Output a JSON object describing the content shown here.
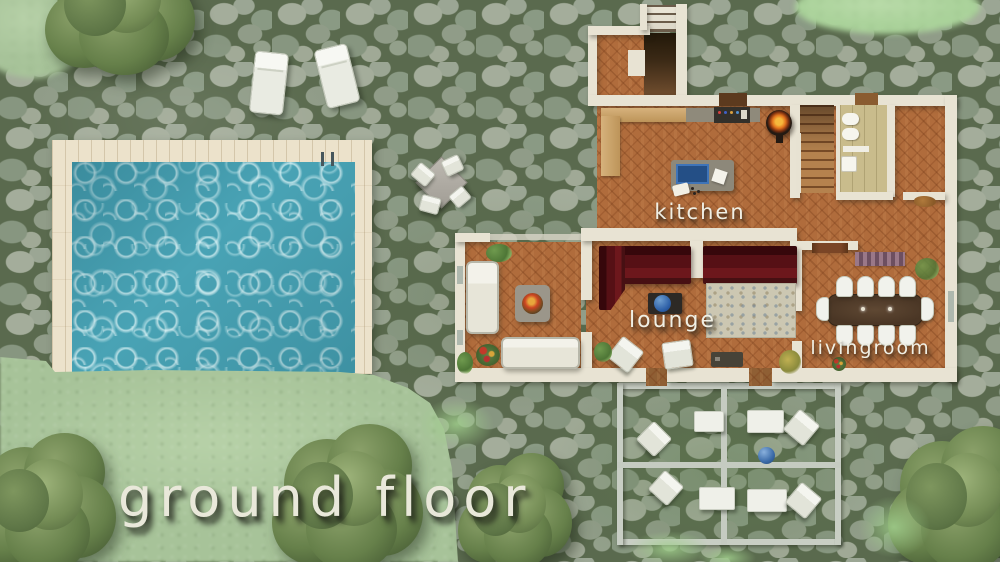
{
  "labels": {
    "title": "ground floor",
    "kitchen": "kitchen",
    "lounge": "lounge",
    "livingroom": "livingroom"
  },
  "palette": {
    "stone": "#8e9b86",
    "grass": "#a7c399",
    "pool_water": "#49a3b5",
    "pool_deck": "#ece2cb",
    "house_wall": "#e8e3d3",
    "terracotta_floor": "#b06c3c",
    "sofa_red": "#561015",
    "accent_blue": "#2c5ea6",
    "label_text": "#f0efe4"
  },
  "scene": {
    "sprites": [
      {
        "name": "tree-top-left",
        "type": "tree",
        "x": 45,
        "y": -62,
        "w": 155,
        "h": 140
      },
      {
        "name": "tree-bottom-left",
        "type": "tree",
        "x": -28,
        "y": 433,
        "w": 148,
        "h": 142
      },
      {
        "name": "tree-bottom-center",
        "type": "tree",
        "x": 272,
        "y": 424,
        "w": 156,
        "h": 150
      },
      {
        "name": "tree-bottom-mid",
        "type": "tree",
        "x": 458,
        "y": 453,
        "w": 118,
        "h": 118
      },
      {
        "name": "tree-bottom-right",
        "type": "tree",
        "x": 888,
        "y": 426,
        "w": 152,
        "h": 148
      },
      {
        "name": "sun-lounger-1",
        "type": "lounger",
        "x": 252,
        "y": 52,
        "w": 34,
        "h": 62,
        "rot": 6
      },
      {
        "name": "sun-lounger-2",
        "type": "lounger",
        "x": 320,
        "y": 46,
        "w": 34,
        "h": 60,
        "rot": -14
      },
      {
        "name": "patio-table",
        "type": "table-diamond",
        "x": 423,
        "y": 164,
        "w": 37,
        "h": 37,
        "rot": 45
      },
      {
        "name": "patio-chair-1",
        "type": "chair",
        "x": 413,
        "y": 166,
        "w": 20,
        "h": 17,
        "rot": 40
      },
      {
        "name": "patio-chair-2",
        "type": "chair",
        "x": 443,
        "y": 157,
        "w": 19,
        "h": 17,
        "rot": -25
      },
      {
        "name": "patio-chair-3",
        "type": "chair",
        "x": 420,
        "y": 196,
        "w": 20,
        "h": 17,
        "rot": 15
      },
      {
        "name": "patio-chair-4",
        "type": "chair",
        "x": 451,
        "y": 189,
        "w": 18,
        "h": 16,
        "rot": -40
      },
      {
        "name": "pergola-chair-1",
        "type": "chair",
        "x": 641,
        "y": 426,
        "w": 26,
        "h": 26,
        "rot": 45
      },
      {
        "name": "pergola-table-1",
        "type": "perg-table",
        "x": 694,
        "y": 411,
        "w": 30,
        "h": 21,
        "rot": 0
      },
      {
        "name": "pergola-table-2",
        "type": "perg-table",
        "x": 747,
        "y": 410,
        "w": 37,
        "h": 23,
        "rot": 0
      },
      {
        "name": "pergola-chair-2",
        "type": "chair",
        "x": 788,
        "y": 414,
        "w": 27,
        "h": 27,
        "rot": 40
      },
      {
        "name": "blue-pot",
        "type": "ball",
        "x": 758,
        "y": 447,
        "w": 17,
        "h": 17,
        "rot": 0
      },
      {
        "name": "pergola-chair-3",
        "type": "chair",
        "x": 653,
        "y": 475,
        "w": 26,
        "h": 26,
        "rot": 42
      },
      {
        "name": "pergola-table-3",
        "type": "perg-table",
        "x": 699,
        "y": 487,
        "w": 36,
        "h": 23,
        "rot": 0
      },
      {
        "name": "pergola-table-4",
        "type": "perg-table",
        "x": 747,
        "y": 489,
        "w": 40,
        "h": 23,
        "rot": 0
      },
      {
        "name": "pergola-chair-4",
        "type": "chair",
        "x": 790,
        "y": 487,
        "w": 27,
        "h": 27,
        "rot": 40
      },
      {
        "name": "moss-patch-1",
        "type": "moss",
        "x": 420,
        "y": 398,
        "w": 74,
        "h": 52
      },
      {
        "name": "moss-patch-2",
        "type": "moss",
        "x": 628,
        "y": 531,
        "w": 82,
        "h": 36
      },
      {
        "name": "moss-patch-3",
        "type": "moss",
        "x": 858,
        "y": 496,
        "w": 72,
        "h": 62
      },
      {
        "name": "moss-patch-4",
        "type": "moss",
        "x": 698,
        "y": 546,
        "w": 58,
        "h": 24
      }
    ]
  }
}
